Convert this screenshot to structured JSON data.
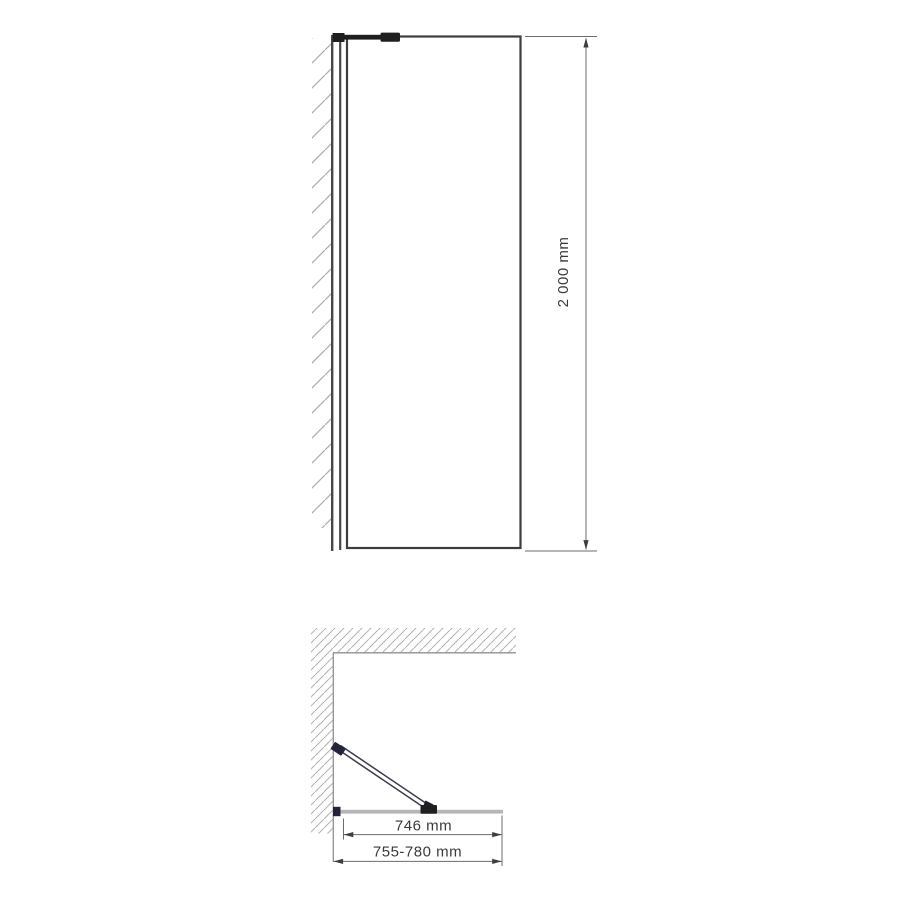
{
  "drawing": {
    "type": "shower-screen-technical-drawing",
    "views": {
      "front_view": "front-elevation",
      "plan_view": "top-view"
    }
  },
  "dimensions": {
    "height": "2 000 mm",
    "glass_width": "746 mm",
    "installation_width": "755-780 mm"
  },
  "colors": {
    "background": "#ffffff",
    "line": "#3d3d3d",
    "dimension_line": "#6b6b6b",
    "hatch": "#aeaeae",
    "glass": "#b6b6b6",
    "hardware": "#1f1f1f",
    "bracket": "#23233a",
    "text": "#3a3a3a"
  }
}
